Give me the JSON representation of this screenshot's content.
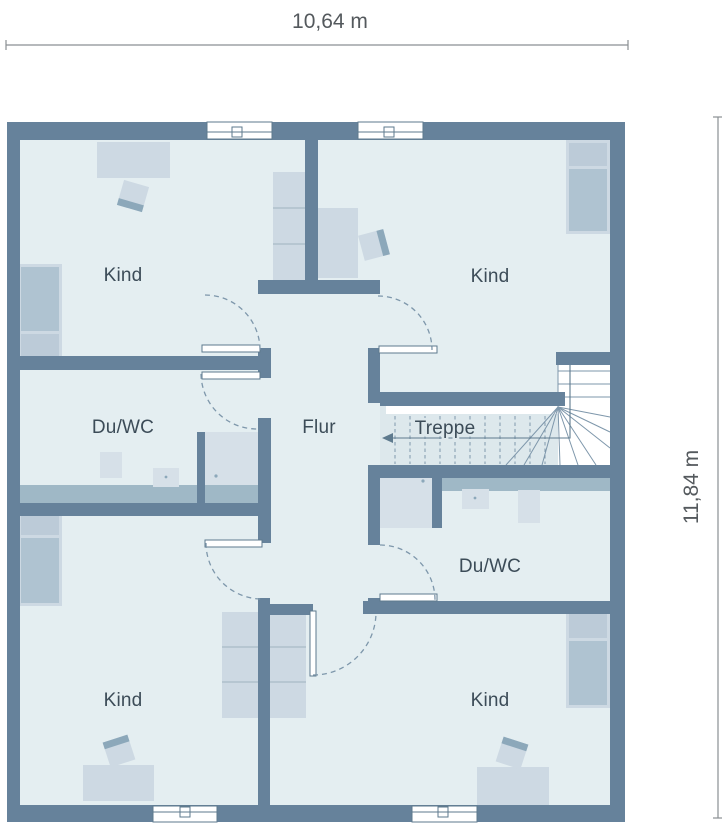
{
  "dimensions": {
    "width_label": "10,64 m",
    "height_label": "11,84 m"
  },
  "rooms": {
    "kind_top_left": {
      "label": "Kind"
    },
    "kind_top_right": {
      "label": "Kind"
    },
    "bath_left": {
      "label": "Du/WC"
    },
    "hall": {
      "label": "Flur"
    },
    "stairs": {
      "label": "Treppe",
      "direction_arrow": "left"
    },
    "bath_right": {
      "label": "Du/WC"
    },
    "kind_bottom_left": {
      "label": "Kind"
    },
    "kind_bottom_right": {
      "label": "Kind"
    }
  },
  "colors": {
    "wall": "#66829B",
    "floor": "#E4EEF1",
    "stair_floor": "#DDE8EC",
    "furniture_light": "#CDD9E3",
    "furniture_mid": "#AFC3D1",
    "furniture_pillow": "#BCCBD8",
    "fixture": "#D6E0E8",
    "counter": "#9FB8C6",
    "chair_back": "#8CA8BA",
    "separator": "#AEBFCB",
    "line": "#7E97AB",
    "outline": "#5E7A8E",
    "text": "#3C4C58",
    "dim_text": "#54595D",
    "dim_line": "#8A8F93"
  }
}
